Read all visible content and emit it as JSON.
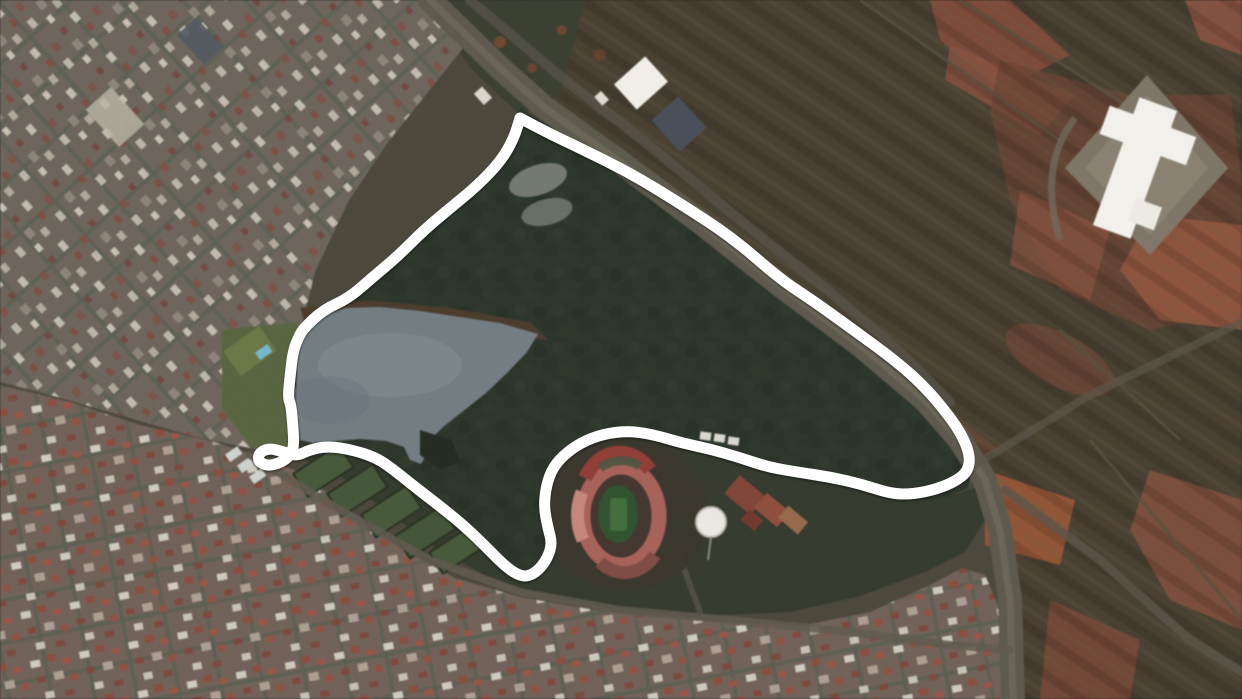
{
  "meta": {
    "view": "satellite-aerial-view",
    "width": 1242,
    "height": 699,
    "scene": "urban-park-with-lake-stadium-and-highlighted-route"
  },
  "colors": {
    "route": "#ffffff",
    "route_width": 11,
    "lake": "#707b80",
    "lake_shore": "#4a3b2c",
    "forest": "#2b352a",
    "park_south": "#343a2d",
    "urban_west": "#6b635a",
    "urban_south": "#6e6057",
    "fields_ne": "#473f31",
    "red_soil": "#8a5140",
    "road": "#5c574c",
    "stadium_ring": "#a56058",
    "stadium_ring_dark": "#8f3d35",
    "stadium_ring_light": "#c4837b",
    "stadium_pitch": "#31512f",
    "water_tank": "#e9e7e0",
    "factory_roof": "#f2f0ea"
  },
  "route": {
    "points": [
      [
        520,
        118
      ],
      [
        544,
        131
      ],
      [
        584,
        150
      ],
      [
        632,
        174
      ],
      [
        681,
        204
      ],
      [
        733,
        238
      ],
      [
        780,
        279
      ],
      [
        812,
        300
      ],
      [
        851,
        328
      ],
      [
        896,
        361
      ],
      [
        926,
        388
      ],
      [
        950,
        417
      ],
      [
        963,
        437
      ],
      [
        970,
        456
      ],
      [
        968,
        471
      ],
      [
        956,
        481
      ],
      [
        937,
        489
      ],
      [
        914,
        494
      ],
      [
        892,
        494
      ],
      [
        861,
        484
      ],
      [
        830,
        477
      ],
      [
        797,
        472
      ],
      [
        768,
        467
      ],
      [
        738,
        457
      ],
      [
        710,
        449
      ],
      [
        682,
        443
      ],
      [
        655,
        435
      ],
      [
        631,
        431
      ],
      [
        608,
        433
      ],
      [
        586,
        440
      ],
      [
        567,
        452
      ],
      [
        553,
        467
      ],
      [
        546,
        486
      ],
      [
        544,
        508
      ],
      [
        548,
        528
      ],
      [
        552,
        543
      ],
      [
        548,
        557
      ],
      [
        539,
        570
      ],
      [
        527,
        577
      ],
      [
        516,
        574
      ],
      [
        504,
        565
      ],
      [
        492,
        553
      ],
      [
        478,
        539
      ],
      [
        463,
        525
      ],
      [
        446,
        511
      ],
      [
        428,
        497
      ],
      [
        410,
        483
      ],
      [
        394,
        470
      ],
      [
        377,
        458
      ],
      [
        353,
        450
      ],
      [
        328,
        446
      ],
      [
        309,
        450
      ],
      [
        297,
        456
      ],
      [
        284,
        452
      ],
      [
        269,
        448
      ],
      [
        259,
        453
      ],
      [
        258,
        461
      ],
      [
        267,
        466
      ],
      [
        280,
        463
      ],
      [
        290,
        456
      ],
      [
        294,
        446
      ],
      [
        293,
        427
      ],
      [
        291,
        405
      ],
      [
        288,
        398
      ],
      [
        290,
        377
      ],
      [
        293,
        351
      ],
      [
        299,
        336
      ],
      [
        304,
        328
      ],
      [
        323,
        310
      ],
      [
        349,
        298
      ],
      [
        373,
        277
      ],
      [
        398,
        256
      ],
      [
        424,
        230
      ],
      [
        449,
        209
      ],
      [
        477,
        186
      ],
      [
        501,
        161
      ],
      [
        514,
        138
      ],
      [
        520,
        118
      ]
    ]
  },
  "features": {
    "lake": {
      "points": [
        [
          303,
          331
        ],
        [
          318,
          317
        ],
        [
          345,
          308
        ],
        [
          380,
          307
        ],
        [
          420,
          311
        ],
        [
          460,
          317
        ],
        [
          500,
          323
        ],
        [
          538,
          334
        ],
        [
          527,
          352
        ],
        [
          508,
          372
        ],
        [
          486,
          393
        ],
        [
          462,
          412
        ],
        [
          443,
          427
        ],
        [
          432,
          438
        ],
        [
          428,
          452
        ],
        [
          421,
          464
        ],
        [
          410,
          460
        ],
        [
          404,
          447
        ],
        [
          386,
          441
        ],
        [
          360,
          439
        ],
        [
          335,
          441
        ],
        [
          313,
          443
        ],
        [
          300,
          440
        ],
        [
          296,
          400
        ],
        [
          297,
          365
        ]
      ]
    },
    "stadium": {
      "cx": 621,
      "cy": 516,
      "rx": 46,
      "ry": 57
    },
    "pitch": {
      "cx": 618,
      "cy": 514,
      "rx": 20,
      "ry": 29
    },
    "water_tank": {
      "cx": 711,
      "cy": 522,
      "r": 15
    }
  }
}
